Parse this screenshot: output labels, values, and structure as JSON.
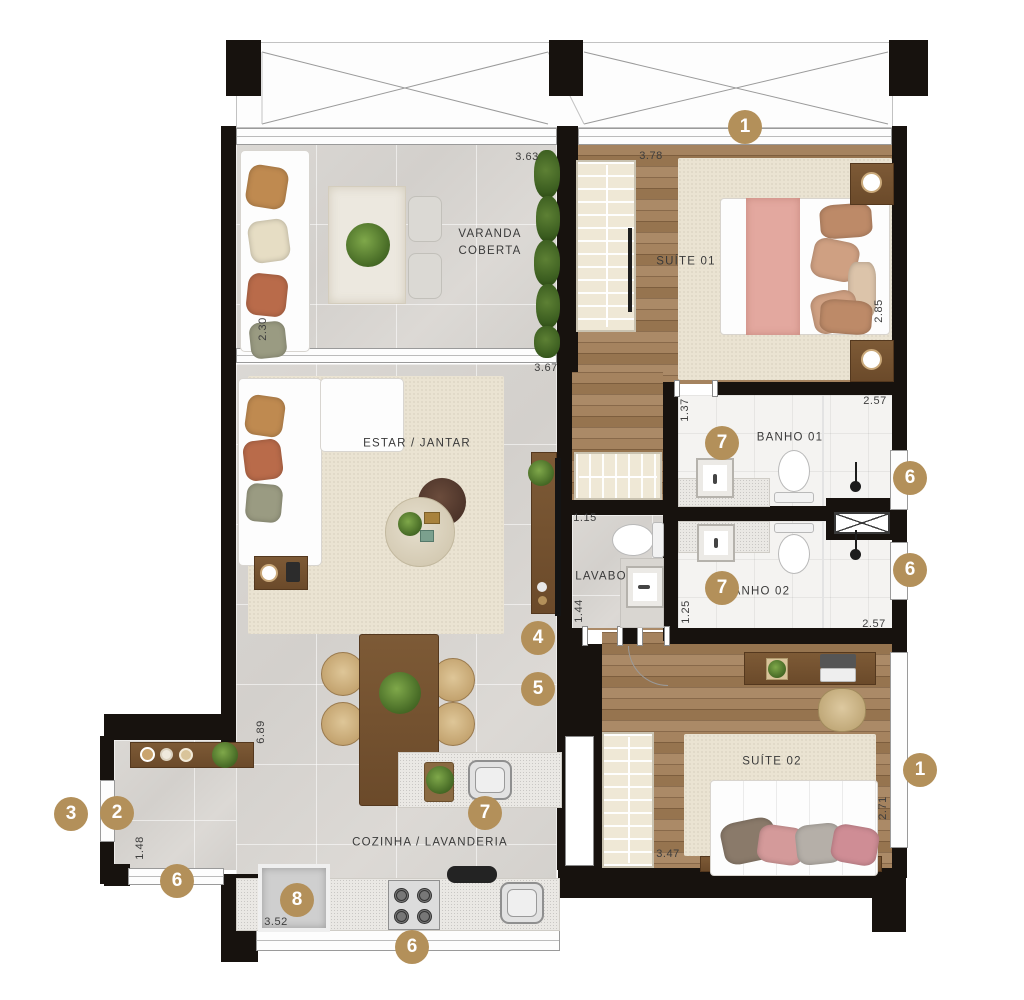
{
  "plan_title": "apartment-floor-plan",
  "colors": {
    "marker_bg": "#b3905a",
    "wall": "#17120e",
    "wood_floor": "#9d7c5e",
    "tile_floor": "#d8d5d1",
    "label_text": "#3a3a3a"
  },
  "rooms": {
    "varanda": {
      "label": "VARANDA\nCOBERTA"
    },
    "suite01": {
      "label": "SUÍTE 01"
    },
    "estar": {
      "label": "ESTAR / JANTAR"
    },
    "banho01": {
      "label": "BANHO 01"
    },
    "lavabo": {
      "label": "LAVABO"
    },
    "banho02": {
      "label": "BANHO 02"
    },
    "suite02": {
      "label": "SUÍTE 02"
    },
    "cozinha": {
      "label": "COZINHA / LAVANDERIA"
    }
  },
  "dimensions": [
    {
      "text": "3.63",
      "x": 527,
      "y": 157,
      "vertical": false
    },
    {
      "text": "3.78",
      "x": 651,
      "y": 156,
      "vertical": false
    },
    {
      "text": "2.30",
      "x": 263,
      "y": 329,
      "vertical": true
    },
    {
      "text": "2.85",
      "x": 879,
      "y": 311,
      "vertical": true
    },
    {
      "text": "3.67",
      "x": 546,
      "y": 368,
      "vertical": false
    },
    {
      "text": "1.37",
      "x": 685,
      "y": 410,
      "vertical": true
    },
    {
      "text": "2.57",
      "x": 875,
      "y": 401,
      "vertical": false
    },
    {
      "text": "1.15",
      "x": 585,
      "y": 518,
      "vertical": false
    },
    {
      "text": "1.44",
      "x": 579,
      "y": 611,
      "vertical": true
    },
    {
      "text": "1.25",
      "x": 686,
      "y": 612,
      "vertical": true
    },
    {
      "text": "2.57",
      "x": 874,
      "y": 624,
      "vertical": false
    },
    {
      "text": "6.89",
      "x": 261,
      "y": 732,
      "vertical": true
    },
    {
      "text": "1.48",
      "x": 140,
      "y": 848,
      "vertical": true
    },
    {
      "text": "3.52",
      "x": 276,
      "y": 922,
      "vertical": false
    },
    {
      "text": "3.47",
      "x": 668,
      "y": 854,
      "vertical": false
    },
    {
      "text": "2.71",
      "x": 883,
      "y": 808,
      "vertical": true
    }
  ],
  "markers": [
    {
      "label": "1",
      "x": 745,
      "y": 127
    },
    {
      "label": "1",
      "x": 920,
      "y": 770
    },
    {
      "label": "2",
      "x": 117,
      "y": 813
    },
    {
      "label": "3",
      "x": 71,
      "y": 814
    },
    {
      "label": "4",
      "x": 538,
      "y": 638
    },
    {
      "label": "5",
      "x": 538,
      "y": 689
    },
    {
      "label": "6",
      "x": 910,
      "y": 478
    },
    {
      "label": "6",
      "x": 910,
      "y": 570
    },
    {
      "label": "6",
      "x": 177,
      "y": 881
    },
    {
      "label": "6",
      "x": 412,
      "y": 947
    },
    {
      "label": "7",
      "x": 722,
      "y": 443
    },
    {
      "label": "7",
      "x": 722,
      "y": 588
    },
    {
      "label": "7",
      "x": 485,
      "y": 813
    },
    {
      "label": "8",
      "x": 297,
      "y": 900
    }
  ]
}
